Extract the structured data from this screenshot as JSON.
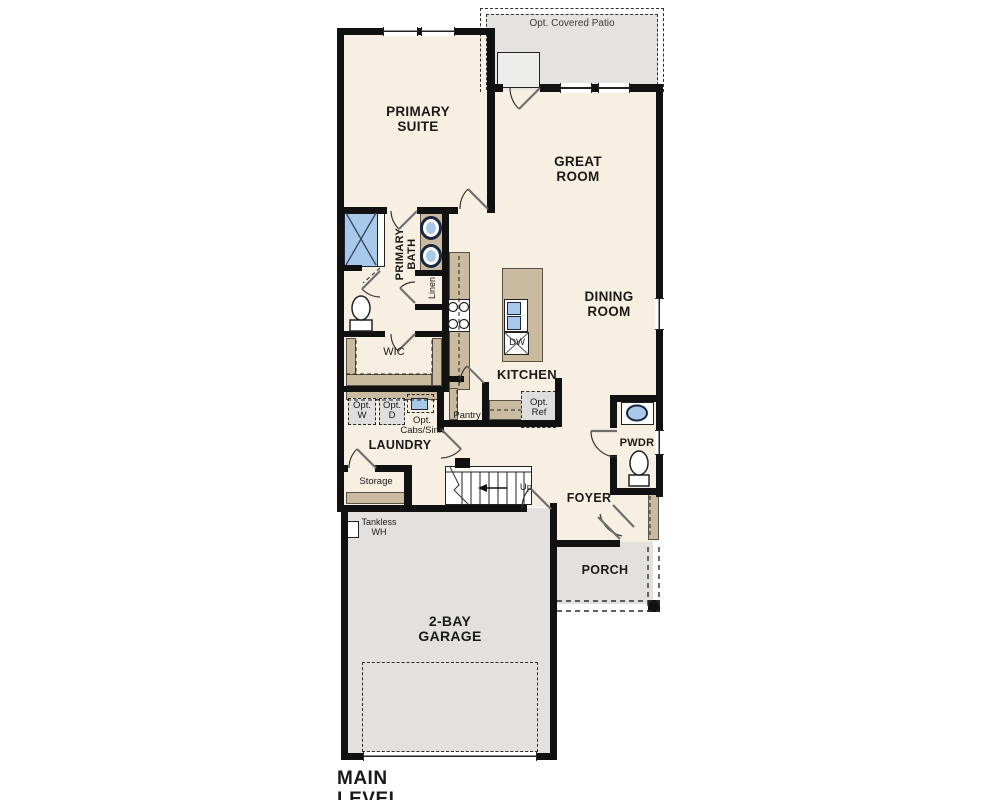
{
  "plan_title": "MAIN LEVEL",
  "labels": {
    "opt_covered_patio": "Opt. Covered Patio",
    "primary_suite": "PRIMARY SUITE",
    "great_room": "GREAT ROOM",
    "dining_room": "DINING ROOM",
    "primary_bath": "PRIMARY BATH",
    "linen": "Linen",
    "wic": "WIC",
    "kitchen": "KITCHEN",
    "dishwasher": "DW",
    "pantry": "Pantry",
    "opt_ref": "Opt. Ref",
    "opt_washer": "Opt. W",
    "opt_dryer": "Opt. D",
    "opt_cabs_sink": "Opt. Cabs/Sink",
    "laundry": "LAUNDRY",
    "storage": "Storage",
    "stairs_up": "Up",
    "tankless_wh": "Tankless WH",
    "powder": "PWDR",
    "foyer": "FOYER",
    "porch": "PORCH",
    "garage": "2-BAY GARAGE"
  },
  "colors": {
    "floor": "#F7EFE2",
    "wall": "#111111",
    "cabinetry": "#C9BAA0",
    "exterior_concrete": "#E2E1DF",
    "optional_item_fill": "#DEDEDE",
    "plumbing_blue": "#A8C9EA"
  },
  "fixtures": [
    "shower-icon",
    "double-sink-vanity-icon",
    "toilet-icon",
    "range-burners-icon",
    "island-sink-icon",
    "dishwasher-icon",
    "powder-sink-icon",
    "stairs-icon",
    "up-arrow-icon",
    "tankless-water-heater-icon",
    "porch-post-icon",
    "window-icon",
    "door-swing-icon"
  ]
}
